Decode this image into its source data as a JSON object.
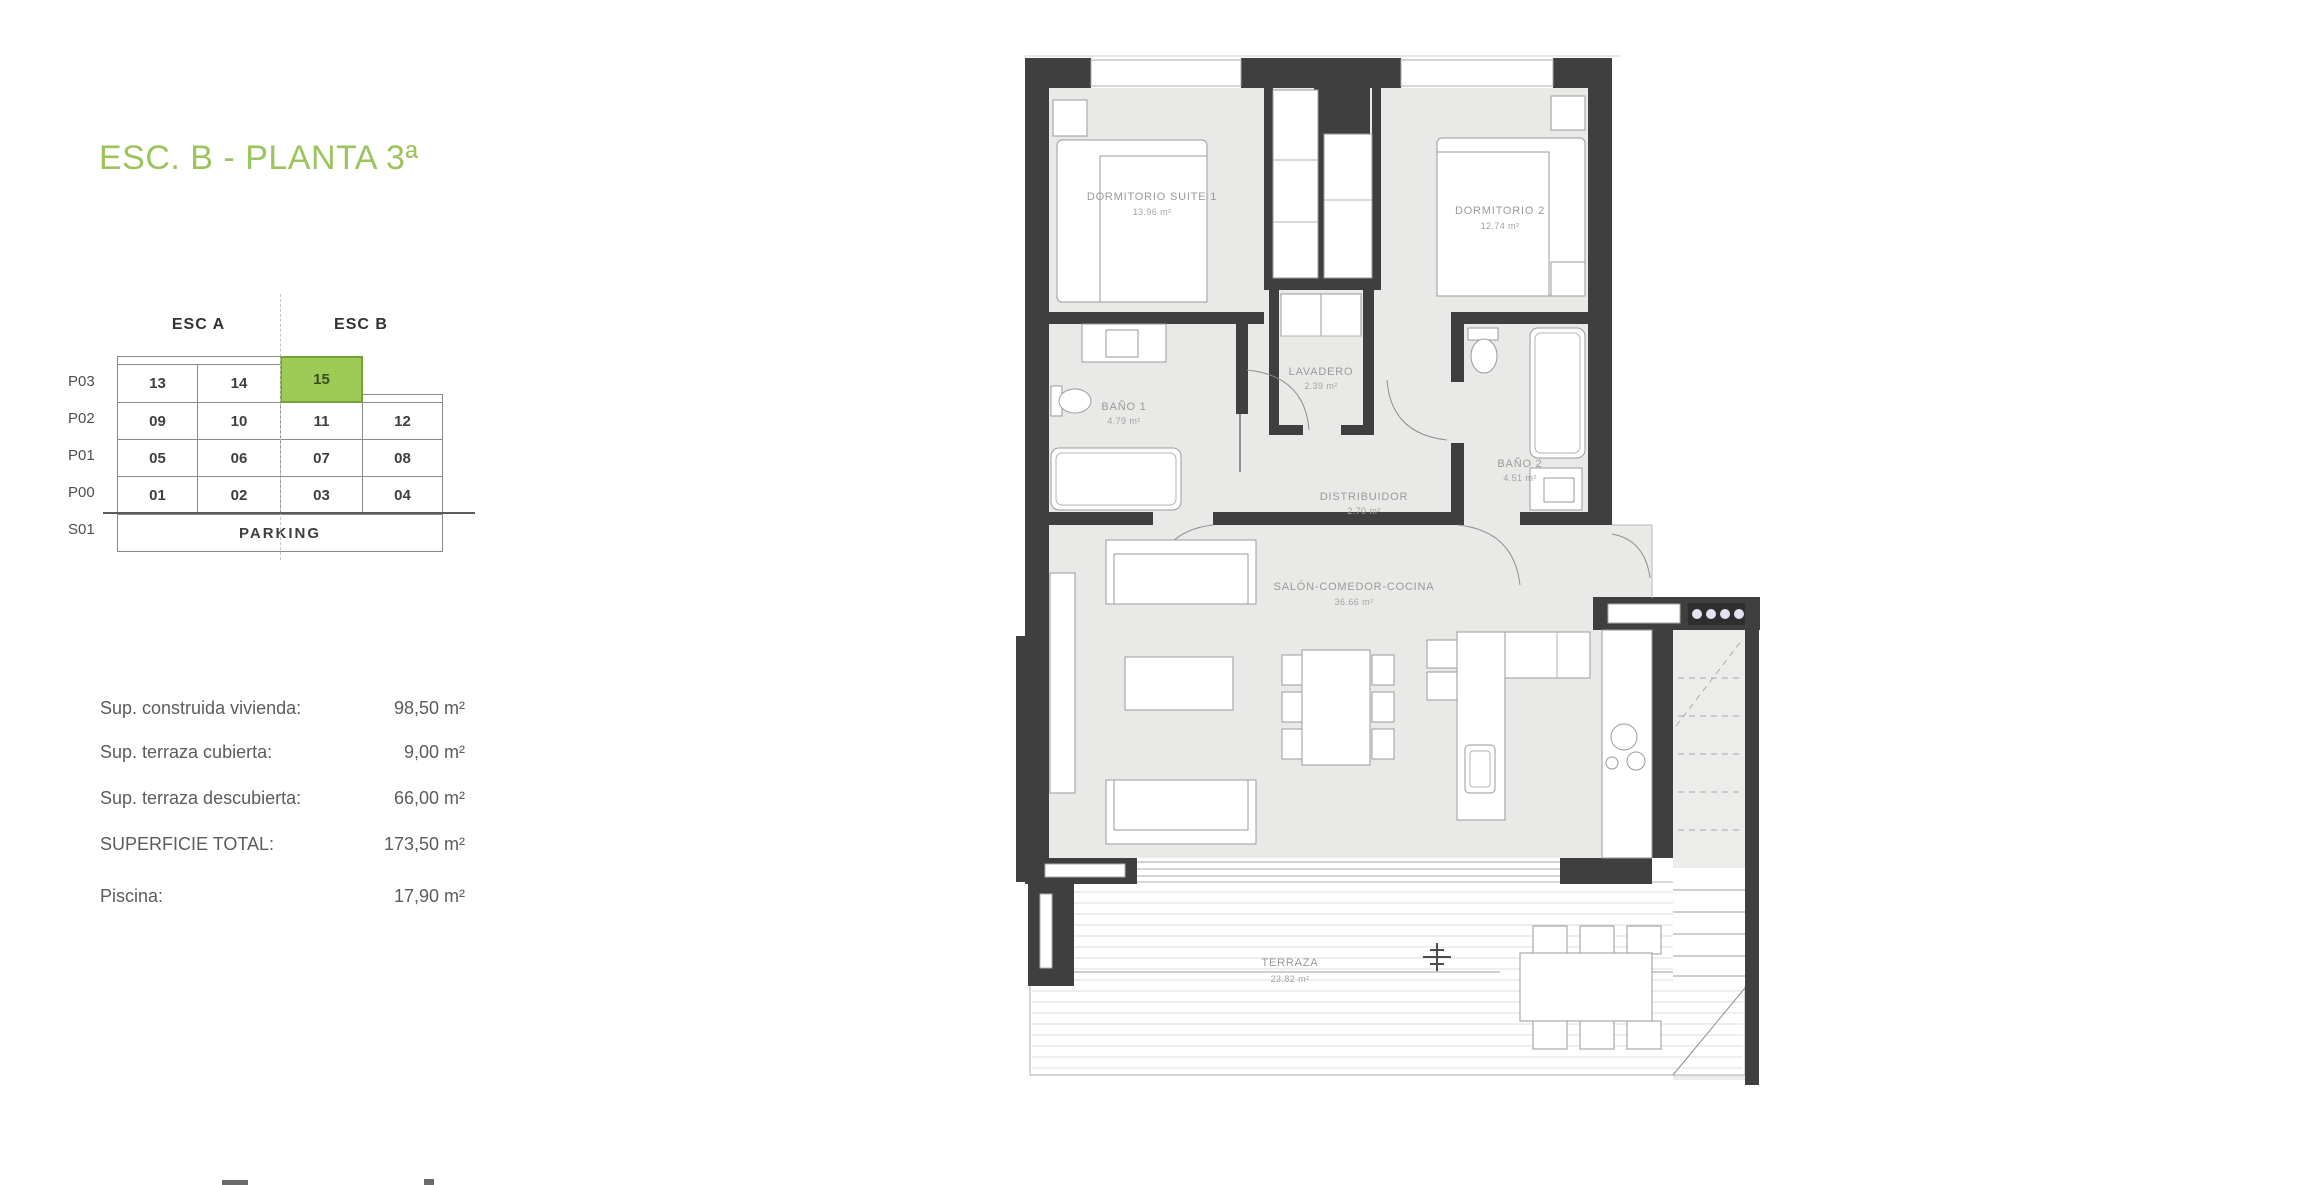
{
  "title": {
    "text": "ESC. B - PLANTA 3ª"
  },
  "colors": {
    "title_green": "#9cc45c",
    "highlight_green": "#9dcb55",
    "highlight_border": "#74a238",
    "wall": "#3f3f3f",
    "floor": "#e9e9e7"
  },
  "unit_table": {
    "col_headers": [
      "ESC A",
      "ESC B"
    ],
    "rows": [
      {
        "label": "P03",
        "cells": [
          "13",
          "14",
          "15"
        ],
        "highlighted_cell": "15"
      },
      {
        "label": "P02",
        "cells": [
          "09",
          "10",
          "11",
          "12"
        ]
      },
      {
        "label": "P01",
        "cells": [
          "05",
          "06",
          "07",
          "08"
        ]
      },
      {
        "label": "P00",
        "cells": [
          "01",
          "02",
          "03",
          "04"
        ]
      },
      {
        "label": "S01",
        "cells": [
          "PARKING"
        ]
      }
    ]
  },
  "measurements": {
    "items": [
      {
        "label": "Sup. construida vivienda:",
        "value": "98,50 m²"
      },
      {
        "label": "Sup. terraza cubierta:",
        "value": "9,00 m²"
      },
      {
        "label": "Sup. terraza descubierta:",
        "value": "66,00 m²"
      },
      {
        "label": "SUPERFICIE TOTAL:",
        "value": "173,50 m²"
      },
      {
        "label": "Piscina:",
        "value": "17,90 m²"
      }
    ]
  },
  "floorplan": {
    "rooms": [
      {
        "name": "DORMITORIO SUITE 1",
        "area": "13.96 m²"
      },
      {
        "name": "DORMITORIO 2",
        "area": "12.74 m²"
      },
      {
        "name": "BAÑO 1",
        "area": "4.79 m²"
      },
      {
        "name": "LAVADERO",
        "area": "2.39 m²"
      },
      {
        "name": "DISTRIBUIDOR",
        "area": "2.70 m²"
      },
      {
        "name": "BAÑO 2",
        "area": "4.51 m²"
      },
      {
        "name": "SALÓN-COMEDOR-COCINA",
        "area": "36.66 m²"
      },
      {
        "name": "TERRAZA",
        "area": "23.82 m²"
      }
    ]
  }
}
